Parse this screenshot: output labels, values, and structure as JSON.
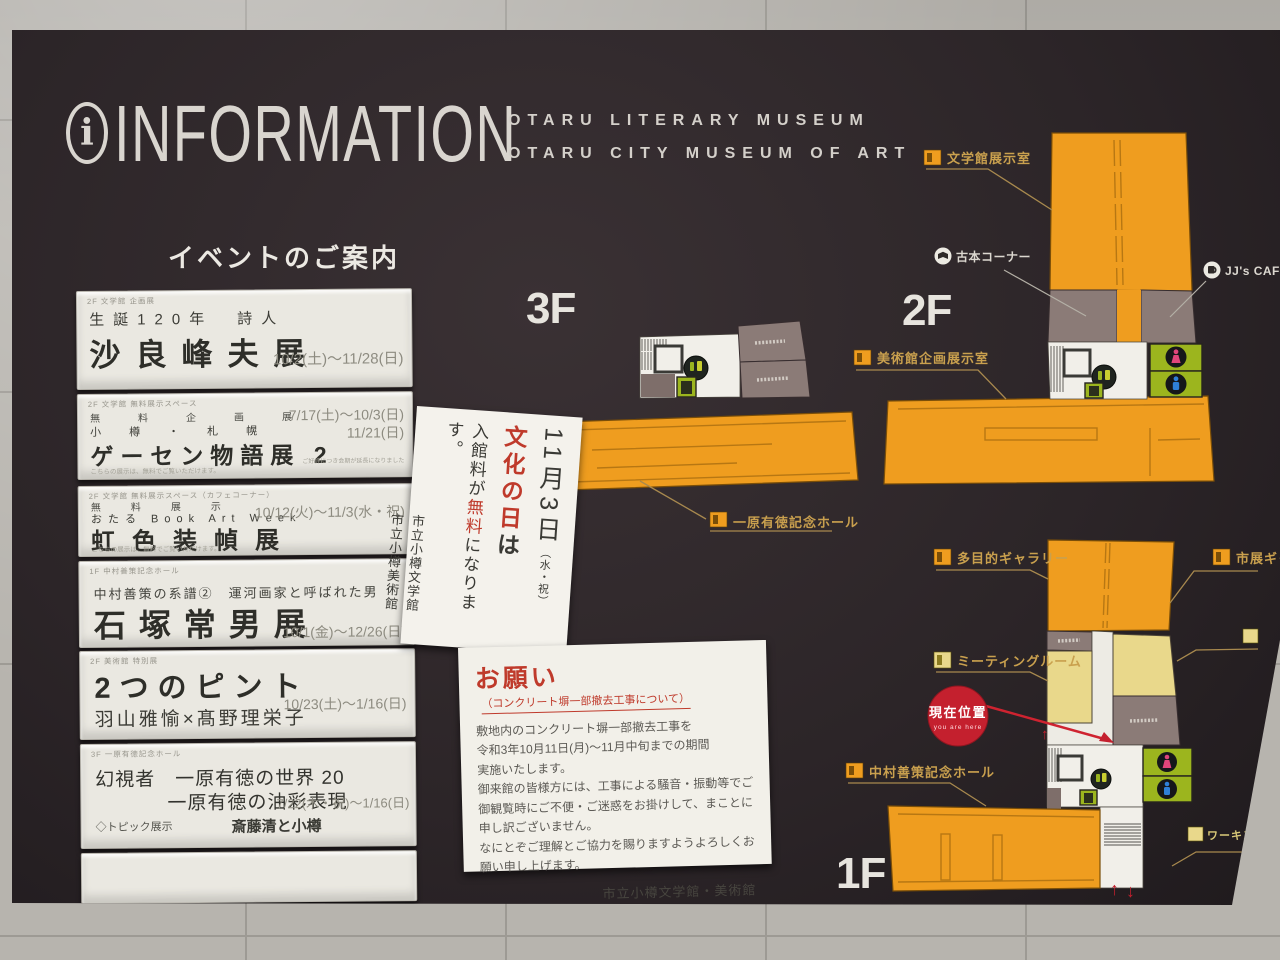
{
  "header": {
    "info_symbol": "i",
    "title": "INFORMATION",
    "subtitle_line1": "OTARU LITERARY MUSEUM",
    "subtitle_line2": "OTARU CITY MUSEUM OF ART"
  },
  "events": {
    "heading": "イベントのご案内",
    "cards": [
      {
        "venue": "2F 文学館 企画展",
        "subtitle": "生誕120年　詩人",
        "title": "沙良峰夫展",
        "dates": "10/2(土)〜11/28(日)"
      },
      {
        "venue": "2F 文学館 無料展示スペース",
        "row1": "無料企画展",
        "row2": "小樽・札幌",
        "title": "ゲーセン物語展 2",
        "dates1": "7/17(土)〜10/3(日)",
        "dates2": "11/21(日)",
        "note_left": "こちらの展示は、無料でご覧いただけます。",
        "note_right": "ご好評につき会期が延長になりました"
      },
      {
        "venue": "2F 文学館 無料展示スペース（カフェコーナー）",
        "row1": "無料展示",
        "row2": "おたる Book Art Week",
        "title": "虹色装幀展",
        "dates": "10/12(火)〜11/3(水・祝)",
        "note_left": "こちらの展示は、無料でご覧いただけます。"
      },
      {
        "venue": "1F 中村善策記念ホール",
        "subtitle": "中村善策の系譜②　運河画家と呼ばれた男",
        "title": "石塚常男展",
        "dates": "10/1(金)〜12/26(日)"
      },
      {
        "venue": "2F 美術館 特別展",
        "title": "2つのピント",
        "subtitle": "羽山雅愉×髙野理栄子",
        "dates": "10/23(土)〜1/16(日)"
      },
      {
        "venue": "3F 一原有徳記念ホール",
        "title_line1": "幻視者　一原有徳の世界 20",
        "title_line2": "一原有徳の油彩表現",
        "dates": "7/22(木・祝)〜1/16(日)",
        "topic_label": "◇トピック展示",
        "topic_value": "斎藤清と小樽"
      }
    ]
  },
  "free_day_notice": {
    "date": "11月3日",
    "date_note": "（水・祝）",
    "title_red": "文化の日",
    "title_black": "は",
    "body_pre": "入館料が",
    "body_red": "無料",
    "body_post": "になります。",
    "org1": "市立小樽文学館",
    "org2": "市立小樽美術館"
  },
  "construction_notice": {
    "title": "お願い",
    "subtitle": "（コンクリート塀一部撤去工事について）",
    "body": [
      "敷地内のコンクリート塀一部撤去工事を",
      "令和3年10月11日(月)〜11月中旬までの期間",
      "実施いたします。",
      "御来館の皆様方には、工事による騒音・振動等でご",
      "御観覧時にご不便・ご迷惑をお掛けして、まことに",
      "申し訳ございません。",
      "なにとぞご理解とご協力を賜りますようよろしくお",
      "願い申し上げます。"
    ],
    "signature": "市立小樽文学館・美術館"
  },
  "floors": {
    "f3": {
      "label": "3F",
      "hall_label": "一原有徳記念ホール"
    },
    "f2": {
      "label": "2F",
      "rooms": [
        "文学館展示室",
        "古本コーナー",
        "JJ's CAFE",
        "美術館企画展示室"
      ]
    },
    "f1": {
      "label": "1F",
      "rooms": [
        "多目的ギャラリー",
        "市展ギャラリー",
        "ミーティングルーム",
        "中村善策記念ホール",
        "ワーキング"
      ],
      "marker": {
        "jp": "現在位置",
        "en": "you are here"
      },
      "arrow_up": "↑",
      "arrow_down": "↓"
    }
  },
  "colors": {
    "board": "#2c2528",
    "orange": "#ef9d1f",
    "brown_room": "#8b7b77",
    "toilet_green": "#9cb51e",
    "female_pink": "#e0457b",
    "male_blue": "#2f80d8",
    "gold_label": "#c9a04e",
    "marker_red": "#c4202e",
    "notice_red": "#bf3a2b"
  }
}
